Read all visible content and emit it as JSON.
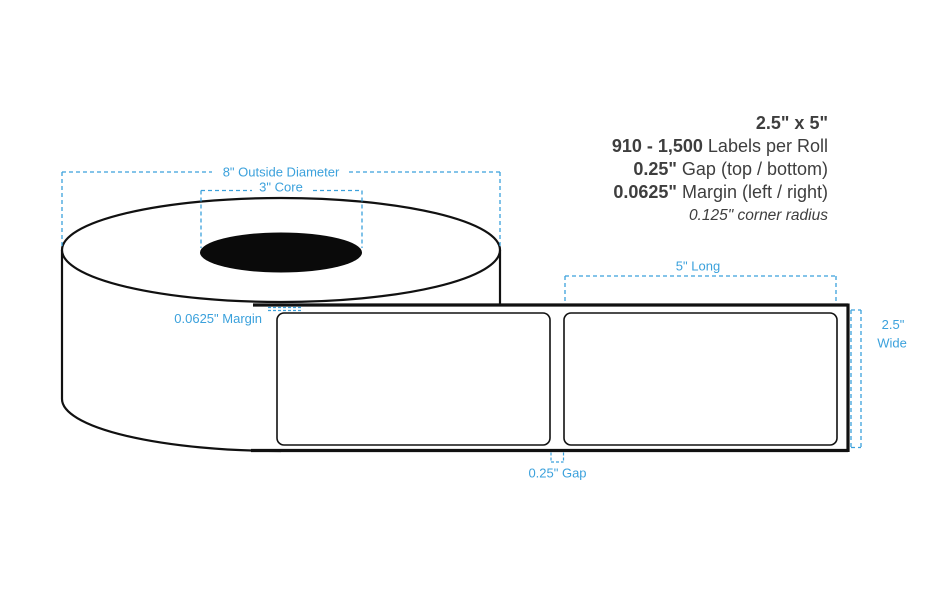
{
  "specs": {
    "size": "2.5\" x 5\"",
    "labels_per_roll_value": "910 - 1,500",
    "labels_per_roll_label": " Labels per Roll",
    "gap_value": "0.25\"",
    "gap_label": " Gap (top / bottom)",
    "margin_value": "0.0625\"",
    "margin_label": " Margin (left / right)",
    "corner_radius_note": "0.125\" corner radius"
  },
  "annotations": {
    "outside_diameter": "8\" Outside Diameter",
    "core": "3\" Core",
    "margin": "0.0625\" Margin",
    "long": "5\" Long",
    "wide_value": "2.5\"",
    "wide_word": "Wide",
    "gap": "0.25\" Gap"
  },
  "colors": {
    "annotation_blue": "#3ba1dc",
    "diagram_ink": "#111111",
    "spec_text": "#3e3e3e",
    "core_fill": "#0a0a0a",
    "background": "#ffffff"
  }
}
